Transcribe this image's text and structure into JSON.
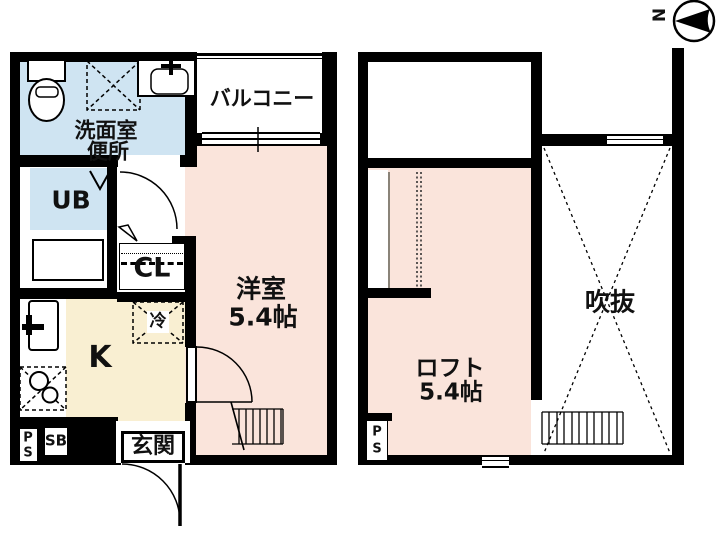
{
  "compass": {
    "north_label": "N"
  },
  "colors": {
    "wall": "#000000",
    "room_pink": "#fae4db",
    "room_blue": "#cfe4f2",
    "room_cream": "#f9efd2",
    "loft_line_gray": "#8a8378"
  },
  "floor1": {
    "washroom_toilet": {
      "line1": "洗面室",
      "line2": "便所"
    },
    "balcony": {
      "label": "バルコニー"
    },
    "unit_bath": {
      "label": "UB"
    },
    "closet": {
      "label": "CL"
    },
    "western_room": {
      "line1": "洋室",
      "line2": "5.4帖"
    },
    "kitchen": {
      "label": "K"
    },
    "refrigerator": {
      "label": "冷"
    },
    "entrance": {
      "label": "玄関"
    },
    "pipe_space": {
      "line1": "P",
      "line2": "S"
    },
    "shoe_box": {
      "label": "SB"
    }
  },
  "floor2": {
    "loft": {
      "line1": "ロフト",
      "line2": "5.4帖"
    },
    "void": {
      "label": "吹抜"
    },
    "pipe_space": {
      "line1": "P",
      "line2": "S"
    }
  }
}
